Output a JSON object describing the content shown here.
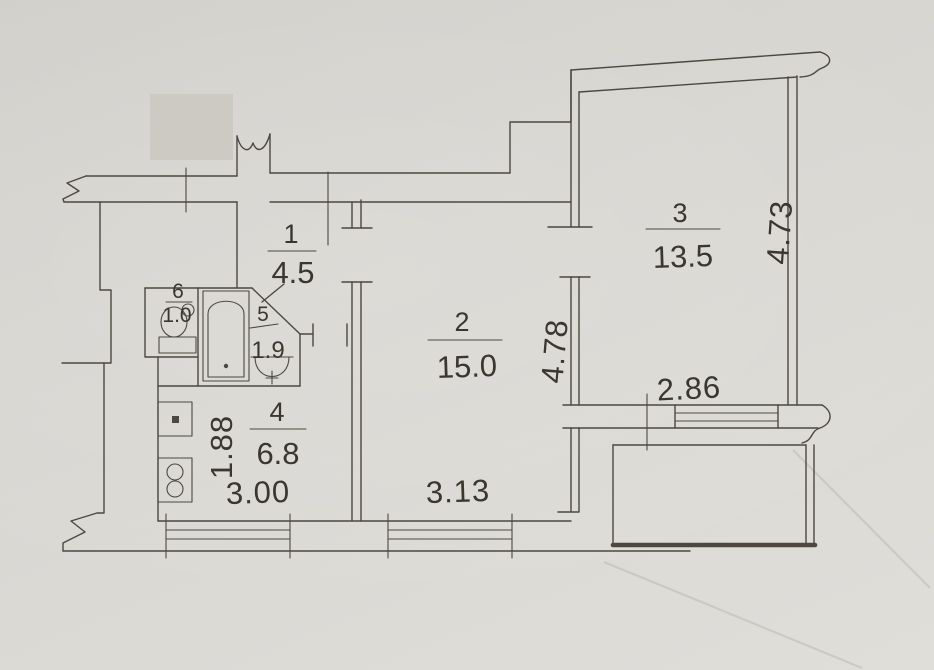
{
  "plan": {
    "rooms": [
      {
        "id": "room-1-hall",
        "number": "1",
        "area": "4.5"
      },
      {
        "id": "room-2-living",
        "number": "2",
        "area": "15.0"
      },
      {
        "id": "room-3-bedroom",
        "number": "3",
        "area": "13.5"
      },
      {
        "id": "room-4-kitchen",
        "number": "4",
        "area": "6.8"
      },
      {
        "id": "room-5-bathroom",
        "number": "5",
        "area": "1.9"
      },
      {
        "id": "room-6-wc",
        "number": "6",
        "area": "1.0"
      }
    ],
    "dimensions": [
      {
        "id": "kitchen-window-width",
        "value": "3.00",
        "orientation": "horizontal"
      },
      {
        "id": "kitchen-depth",
        "value": "1.88",
        "orientation": "vertical"
      },
      {
        "id": "room-2-window-width",
        "value": "3.13",
        "orientation": "horizontal"
      },
      {
        "id": "room-2-depth",
        "value": "4.78",
        "orientation": "vertical"
      },
      {
        "id": "room-3-window-width",
        "value": "2.86",
        "orientation": "horizontal"
      },
      {
        "id": "room-3-depth",
        "value": "4.73",
        "orientation": "vertical"
      }
    ],
    "fixtures": [
      "toilet",
      "bathtub",
      "washbasin",
      "kitchen-sink",
      "stove"
    ],
    "colors": {
      "paper": "#d8d6d1",
      "ink": "#4d4740",
      "text_ink": "#3b362f"
    }
  }
}
